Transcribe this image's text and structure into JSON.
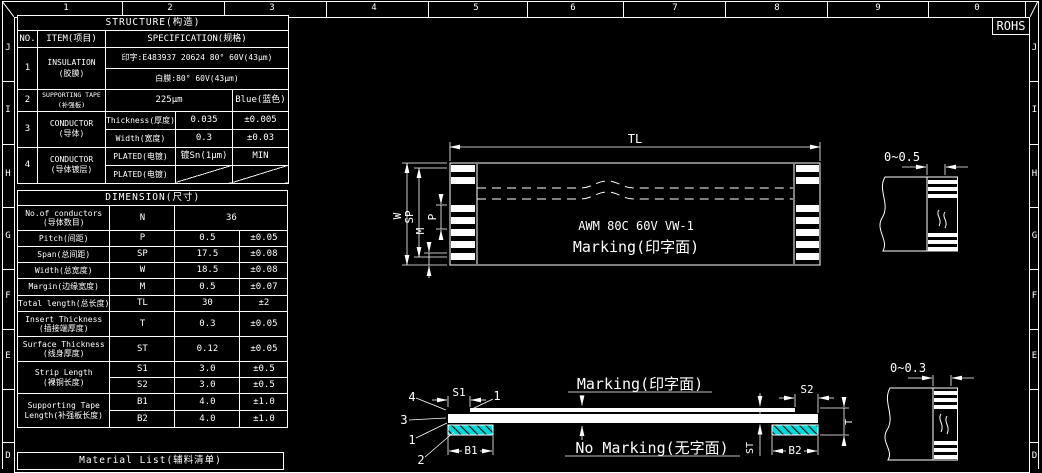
{
  "frame": {
    "rohs": "ROHS",
    "top_ruler": [
      "1",
      "2",
      "3",
      "4",
      "5",
      "6",
      "7",
      "8",
      "9",
      "0"
    ],
    "left_ruler": [
      "J",
      "I",
      "H",
      "G",
      "F",
      "E",
      "D"
    ],
    "right_ruler": [
      "J",
      "I",
      "H",
      "G",
      "F",
      "E",
      "D"
    ]
  },
  "structure": {
    "title": "STRUCTURE(构造)",
    "col_no": "NO.",
    "col_item": "ITEM(项目)",
    "col_spec": "SPECIFICATION(规格)",
    "row1": {
      "no": "1",
      "item": "INSULATION",
      "item_cn": "(胶膜)",
      "spec1": "印字:E483937 20624 80° 60V(43μm)",
      "spec2": "白膜:80° 60V(43μm)"
    },
    "row2": {
      "no": "2",
      "item": "SUPPORTING TAPE",
      "item_cn": "(补强板)",
      "value": "225μm",
      "color": "Blue(蓝色)"
    },
    "row3": {
      "no": "3",
      "item": "CONDUCTOR",
      "item_cn": "(导体)",
      "sub1_label": "Thickness(厚度)",
      "sub1_value": "0.035",
      "sub1_tol": "±0.005",
      "sub2_label": "Width(宽度)",
      "sub2_value": "0.3",
      "sub2_tol": "±0.03"
    },
    "row4": {
      "no": "4",
      "item": "CONDUCTOR",
      "item_cn": "(导体镀层)",
      "sub1_label": "PLATED(电镀)",
      "sub1_value": "镀Sn(1μm)",
      "sub1_tol": "MIN",
      "sub2_label": "PLATED(电镀)"
    }
  },
  "dimension": {
    "title": "DIMENSION(尺寸)",
    "rows": [
      {
        "label": "No.of conductors",
        "label_cn": "(导体数目)",
        "sym": "N",
        "value": "36"
      },
      {
        "label": "Pitch(间距)",
        "sym": "P",
        "value": "0.5",
        "tol": "±0.05"
      },
      {
        "label": "Span(总间距)",
        "sym": "SP",
        "value": "17.5",
        "tol": "±0.08"
      },
      {
        "label": "Width(总宽度)",
        "sym": "W",
        "value": "18.5",
        "tol": "±0.08"
      },
      {
        "label": "Margin(边缘宽度)",
        "sym": "M",
        "value": "0.5",
        "tol": "±0.07"
      },
      {
        "label": "Total length(总长度)",
        "sym": "TL",
        "value": "30",
        "tol": "±2"
      },
      {
        "label": "Insert Thickness",
        "label_cn": "(插接端厚度)",
        "sym": "T",
        "value": "0.3",
        "tol": "±0.05"
      },
      {
        "label": "Surface Thickness",
        "label_cn": "(线身厚度)",
        "sym": "ST",
        "value": "0.12",
        "tol": "±0.05"
      }
    ],
    "strip": {
      "label": "Strip Length",
      "label_cn": "(裸铜长度)",
      "s1_sym": "S1",
      "s1_value": "3.0",
      "s1_tol": "±0.5",
      "s2_sym": "S2",
      "s2_value": "3.0",
      "s2_tol": "±0.5"
    },
    "tape": {
      "label": "Supporting Tape",
      "label_cn": "Length(补强板长度)",
      "b1_sym": "B1",
      "b1_value": "4.0",
      "b1_tol": "±1.0",
      "b2_sym": "B2",
      "b2_value": "4.0",
      "b2_tol": "±1.0"
    }
  },
  "material_list": {
    "title": "Material List(辅料清单)"
  },
  "plan_view": {
    "dim_tl": "TL",
    "dim_w": "W",
    "dim_sp": "SP",
    "dim_m": "M",
    "dim_p": "P",
    "cable_text": "AWM 80C 60V VW-1",
    "marking": "Marking(印字面)"
  },
  "side_view": {
    "marking": "Marking(印字面)",
    "no_marking": "No Marking(无字面)",
    "dim_s1": "S1",
    "dim_s2": "S2",
    "dim_b1": "B1",
    "dim_b2": "B2",
    "dim_t": "T",
    "dim_st": "ST",
    "callout_plating": "4",
    "callout_conductor": "3",
    "callout_bottom_film": "1",
    "callout_tape": "2",
    "callout_top_film": "1"
  },
  "detail_views": {
    "top_dim": "0~0.5",
    "bottom_dim": "0~0.3"
  },
  "colors": {
    "background": "#000000",
    "line": "#ffffff",
    "tape_fill": "#00d9d9"
  }
}
